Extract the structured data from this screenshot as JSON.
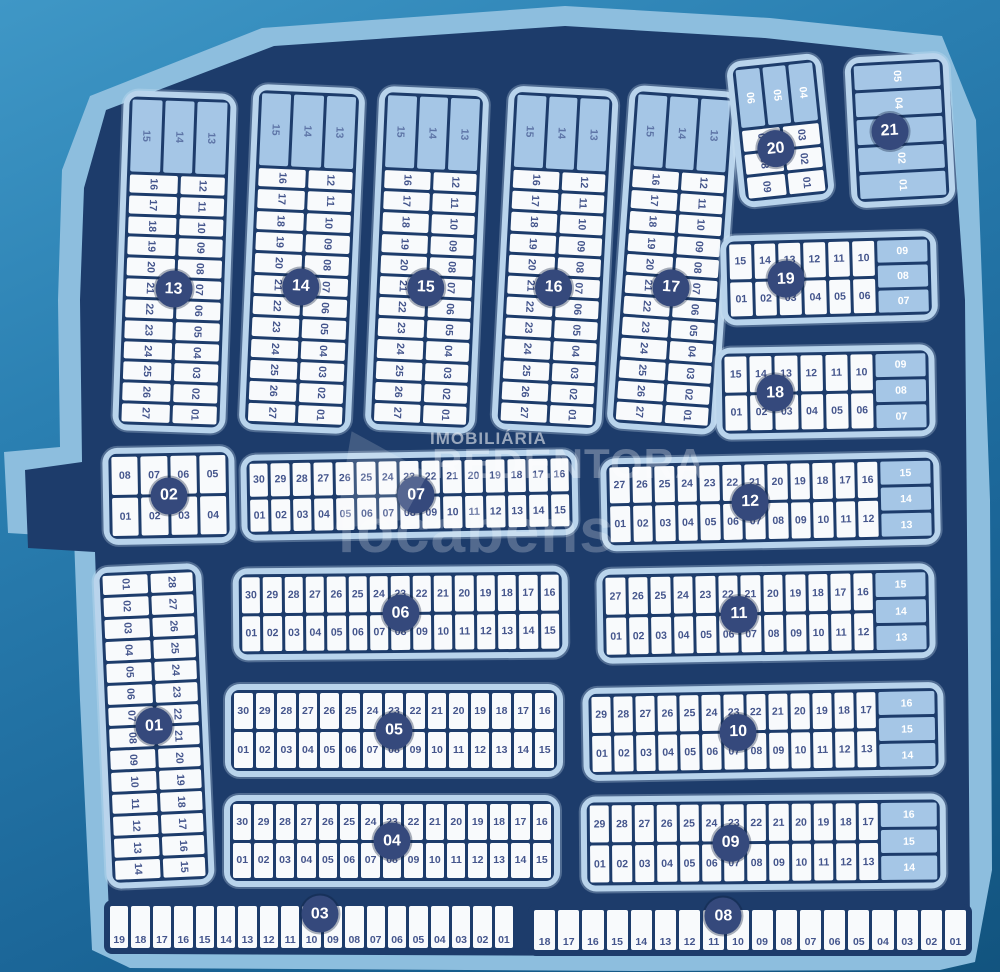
{
  "watermark": {
    "line1": "IMOBILIÁRIA",
    "line2": "REDENTORA",
    "line3": "locabens"
  },
  "colors": {
    "parcel_band": "#8dbede",
    "parcel_fill": "#1d3c6b",
    "block_bg": "#b9d4ec",
    "cell_bg": "#f8fafc",
    "cell_light": "#a5c6e6",
    "line": "#1d3c6b",
    "number": "#44558c",
    "band_number": "#5d74a6",
    "circle_bg": "#35497c",
    "circle_text": "#ffffff"
  },
  "map": {
    "blocks": [
      {
        "id": "01",
        "layout": "vcols",
        "cols": [
          [
            "01",
            "02",
            "03",
            "04",
            "05",
            "06",
            "07",
            "08",
            "09",
            "10",
            "11",
            "12",
            "13",
            "14"
          ],
          [
            "28",
            "27",
            "26",
            "25",
            "24",
            "23",
            "22",
            "21",
            "20",
            "19",
            "18",
            "17",
            "16",
            "15"
          ]
        ]
      },
      {
        "id": "02",
        "layout": "rows",
        "rows": [
          [
            "08",
            "07",
            "06",
            "05"
          ],
          [
            "01",
            "02",
            "03",
            "04"
          ]
        ]
      },
      {
        "id": "03",
        "layout": "row1",
        "rows": [
          [
            "19",
            "18",
            "17",
            "16",
            "15",
            "14",
            "13",
            "12",
            "11",
            "10",
            "09",
            "08",
            "07",
            "06",
            "05",
            "04",
            "03",
            "02",
            "01"
          ]
        ]
      },
      {
        "id": "04",
        "layout": "rows",
        "rows": [
          [
            "30",
            "29",
            "28",
            "27",
            "26",
            "25",
            "24",
            "23",
            "22",
            "21",
            "20",
            "19",
            "18",
            "17",
            "16"
          ],
          [
            "01",
            "02",
            "03",
            "04",
            "05",
            "06",
            "07",
            "08",
            "09",
            "10",
            "11",
            "12",
            "13",
            "14",
            "15"
          ]
        ]
      },
      {
        "id": "05",
        "layout": "rows",
        "rows": [
          [
            "30",
            "29",
            "28",
            "27",
            "26",
            "25",
            "24",
            "23",
            "22",
            "21",
            "20",
            "19",
            "18",
            "17",
            "16"
          ],
          [
            "01",
            "02",
            "03",
            "04",
            "05",
            "06",
            "07",
            "08",
            "09",
            "10",
            "11",
            "12",
            "13",
            "14",
            "15"
          ]
        ]
      },
      {
        "id": "06",
        "layout": "rows",
        "rows": [
          [
            "30",
            "29",
            "28",
            "27",
            "26",
            "25",
            "24",
            "23",
            "22",
            "21",
            "20",
            "19",
            "18",
            "17",
            "16"
          ],
          [
            "01",
            "02",
            "03",
            "04",
            "05",
            "06",
            "07",
            "08",
            "09",
            "10",
            "11",
            "12",
            "13",
            "14",
            "15"
          ]
        ]
      },
      {
        "id": "07",
        "layout": "rows",
        "rows": [
          [
            "30",
            "29",
            "28",
            "27",
            "26",
            "25",
            "24",
            "23",
            "22",
            "21",
            "20",
            "19",
            "18",
            "17",
            "16"
          ],
          [
            "01",
            "02",
            "03",
            "04",
            "05",
            "06",
            "07",
            "08",
            "09",
            "10",
            "11",
            "12",
            "13",
            "14",
            "15"
          ]
        ]
      },
      {
        "id": "08",
        "layout": "row1",
        "rows": [
          [
            "18",
            "17",
            "16",
            "15",
            "14",
            "13",
            "12",
            "11",
            "10",
            "09",
            "08",
            "07",
            "06",
            "05",
            "04",
            "03",
            "02",
            "01"
          ]
        ]
      },
      {
        "id": "09",
        "layout": "rows",
        "rows": [
          [
            "29",
            "28",
            "27",
            "26",
            "25",
            "24",
            "23",
            "22",
            "21",
            "20",
            "19",
            "18",
            "17"
          ],
          [
            "01",
            "02",
            "03",
            "04",
            "05",
            "06",
            "07",
            "08",
            "09",
            "10",
            "11",
            "12",
            "13"
          ]
        ],
        "side": [
          "16",
          "15",
          "14"
        ]
      },
      {
        "id": "10",
        "layout": "rows",
        "rows": [
          [
            "29",
            "28",
            "27",
            "26",
            "25",
            "24",
            "23",
            "22",
            "21",
            "20",
            "19",
            "18",
            "17"
          ],
          [
            "01",
            "02",
            "03",
            "04",
            "05",
            "06",
            "07",
            "08",
            "09",
            "10",
            "11",
            "12",
            "13"
          ]
        ],
        "side": [
          "16",
          "15",
          "14"
        ]
      },
      {
        "id": "11",
        "layout": "rows",
        "rows": [
          [
            "27",
            "26",
            "25",
            "24",
            "23",
            "22",
            "21",
            "20",
            "19",
            "18",
            "17",
            "16"
          ],
          [
            "01",
            "02",
            "03",
            "04",
            "05",
            "06",
            "07",
            "08",
            "09",
            "10",
            "11",
            "12"
          ]
        ],
        "side": [
          "15",
          "14",
          "13"
        ]
      },
      {
        "id": "12",
        "layout": "rows",
        "rows": [
          [
            "27",
            "26",
            "25",
            "24",
            "23",
            "22",
            "21",
            "20",
            "19",
            "18",
            "17",
            "16"
          ],
          [
            "01",
            "02",
            "03",
            "04",
            "05",
            "06",
            "07",
            "08",
            "09",
            "10",
            "11",
            "12"
          ]
        ],
        "side": [
          "15",
          "14",
          "13"
        ]
      },
      {
        "id": "13",
        "layout": "vband",
        "band": [
          "15",
          "14",
          "13"
        ],
        "cols": [
          [
            "16",
            "17",
            "18",
            "19",
            "20",
            "21",
            "22",
            "23",
            "24",
            "25",
            "26",
            "27"
          ],
          [
            "12",
            "11",
            "10",
            "09",
            "08",
            "07",
            "06",
            "05",
            "04",
            "03",
            "02",
            "01"
          ]
        ]
      },
      {
        "id": "14",
        "layout": "vband",
        "band": [
          "15",
          "14",
          "13"
        ],
        "cols": [
          [
            "16",
            "17",
            "18",
            "19",
            "20",
            "21",
            "22",
            "23",
            "24",
            "25",
            "26",
            "27"
          ],
          [
            "12",
            "11",
            "10",
            "09",
            "08",
            "07",
            "06",
            "05",
            "04",
            "03",
            "02",
            "01"
          ]
        ]
      },
      {
        "id": "15",
        "layout": "vband",
        "band": [
          "15",
          "14",
          "13"
        ],
        "cols": [
          [
            "16",
            "17",
            "18",
            "19",
            "20",
            "21",
            "22",
            "23",
            "24",
            "25",
            "26",
            "27"
          ],
          [
            "12",
            "11",
            "10",
            "09",
            "08",
            "07",
            "06",
            "05",
            "04",
            "03",
            "02",
            "01"
          ]
        ]
      },
      {
        "id": "16",
        "layout": "vband",
        "band": [
          "15",
          "14",
          "13"
        ],
        "cols": [
          [
            "16",
            "17",
            "18",
            "19",
            "20",
            "21",
            "22",
            "23",
            "24",
            "25",
            "26",
            "27"
          ],
          [
            "12",
            "11",
            "10",
            "09",
            "08",
            "07",
            "06",
            "05",
            "04",
            "03",
            "02",
            "01"
          ]
        ]
      },
      {
        "id": "17",
        "layout": "vband",
        "band": [
          "15",
          "14",
          "13"
        ],
        "cols": [
          [
            "16",
            "17",
            "18",
            "19",
            "20",
            "21",
            "22",
            "23",
            "24",
            "25",
            "26",
            "27"
          ],
          [
            "12",
            "11",
            "10",
            "09",
            "08",
            "07",
            "06",
            "05",
            "04",
            "03",
            "02",
            "01"
          ]
        ]
      },
      {
        "id": "18",
        "layout": "rows",
        "rows": [
          [
            "15",
            "14",
            "13",
            "12",
            "11",
            "10"
          ],
          [
            "01",
            "02",
            "03",
            "04",
            "05",
            "06"
          ]
        ],
        "side": [
          "09",
          "08",
          "07"
        ]
      },
      {
        "id": "19",
        "layout": "rows",
        "rows": [
          [
            "15",
            "14",
            "13",
            "12",
            "11",
            "10"
          ],
          [
            "01",
            "02",
            "03",
            "04",
            "05",
            "06"
          ]
        ],
        "side": [
          "09",
          "08",
          "07"
        ]
      },
      {
        "id": "20",
        "layout": "vband",
        "band": [
          "06",
          "05",
          "04"
        ],
        "cols": [
          [
            "07",
            "08",
            "09"
          ],
          [
            "03",
            "02",
            "01"
          ]
        ]
      },
      {
        "id": "21",
        "layout": "vstack",
        "cells": [
          "05",
          "04",
          "03",
          "02",
          "01"
        ]
      }
    ]
  }
}
